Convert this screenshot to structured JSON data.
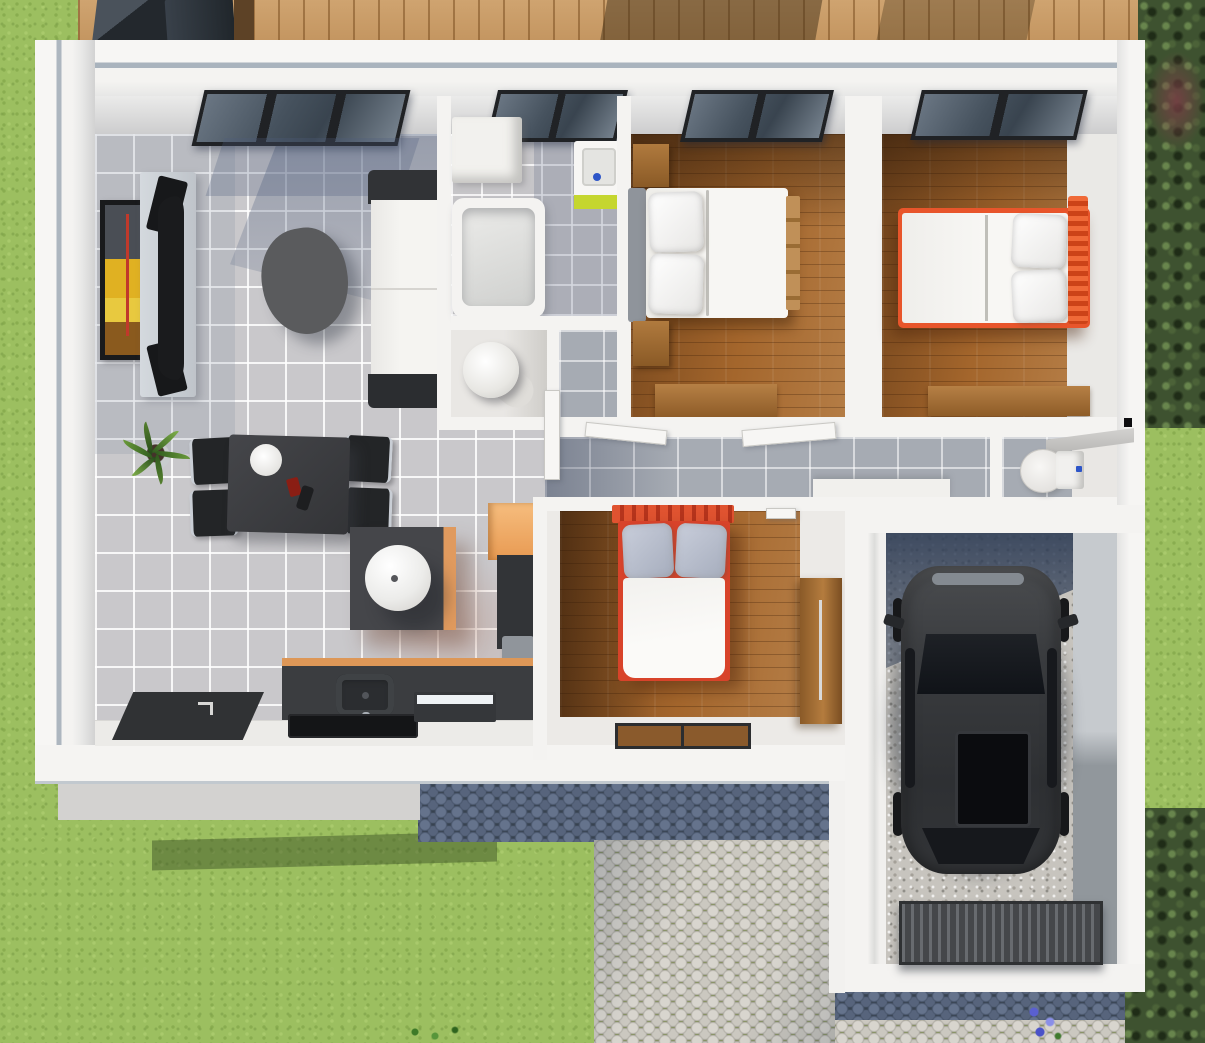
{
  "scene": {
    "type": "3d-floor-plan-render",
    "view": "top-down isometric",
    "counts": {
      "bedrooms": 3,
      "bathrooms": 2,
      "garage_cars": 1
    },
    "house": {
      "rooms": [
        {
          "name": "living-room-kitchen",
          "floor": "gray-ceramic-tile",
          "furniture": [
            "wall-art",
            "tv-wall-unit",
            "coffee-table",
            "sofa",
            "potted-plant",
            "dining-table",
            "dining-chairs-x4",
            "kitchen-island",
            "sphere-lamp",
            "orange-wall-cabinet",
            "tall-cabinet",
            "kitchen-counter",
            "sink",
            "cooktop",
            "dishwasher",
            "entry-door-mat",
            "skylight-window"
          ]
        },
        {
          "name": "bathroom",
          "floor": "gray-tile",
          "furniture": [
            "storage-bench",
            "vanity-sink-lime",
            "bathtub",
            "skylight-window"
          ]
        },
        {
          "name": "utility-closet",
          "floor": "white",
          "furniture": [
            "water-heater-cylinder",
            "door"
          ]
        },
        {
          "name": "bedroom-1",
          "floor": "hardwood",
          "furniture": [
            "double-bed-white",
            "gray-headboard",
            "nightstand-top",
            "nightstand-bottom",
            "dresser",
            "skylight-window"
          ]
        },
        {
          "name": "bedroom-2",
          "floor": "hardwood",
          "furniture": [
            "double-bed-orange-frame",
            "orange-headboard",
            "dresser",
            "skylight-window"
          ]
        },
        {
          "name": "hallway",
          "floor": "gray-tile",
          "furniture": [
            "white-sideboard",
            "door-bedroom-1",
            "door-bedroom-2"
          ]
        },
        {
          "name": "wc",
          "floor": "gray-tile",
          "furniture": [
            "toilet",
            "corner-shelf",
            "wall-switch"
          ]
        },
        {
          "name": "bedroom-3",
          "floor": "hardwood",
          "furniture": [
            "double-bed-red-frame",
            "striped-headboard",
            "wardrobe",
            "door-mat-left",
            "door-mat-right",
            "door"
          ]
        },
        {
          "name": "garage",
          "floor": "gravel",
          "furniture": [
            "car-dark-gray",
            "garage-door-ribbed"
          ]
        }
      ]
    },
    "exterior": {
      "features": [
        "lawn",
        "wood-deck",
        "patio-furniture-dark",
        "hedges-right",
        "red-shrub",
        "cobblestone-driveway-shadowed",
        "cobblestone-walkway",
        "porch-step",
        "garage-apron",
        "blue-flowers",
        "grass-sprig",
        "tree-shadows-on-deck",
        "house-shadow-on-grass"
      ]
    },
    "palette": {
      "grass": "#9cbf60",
      "deck_wood": "#bf8c53",
      "hedge": "#3e5230",
      "wall_white": "#f4f3f1",
      "wall_edge_line": "#a9b3bd",
      "tile_floor": "#c9c8cb",
      "tile_shadow": "#8e9aae",
      "hall_tile": "#a6abb3",
      "hardwood": "#a4662c",
      "bed_orange": "#e8552b",
      "bed_red": "#d8432a",
      "accent_peach": "#f2b26e",
      "accent_lime": "#c5d62f",
      "counter_charcoal": "#3b3d40",
      "counter_edge_orange": "#dd9757",
      "sofa_dark": "#313336",
      "car_body": "#36383b",
      "gravel": "#c7c4be",
      "cobble_light": "#d8d5ce",
      "cobble_dark": "#65738c",
      "faucet_blue": "#2d55c8"
    }
  }
}
